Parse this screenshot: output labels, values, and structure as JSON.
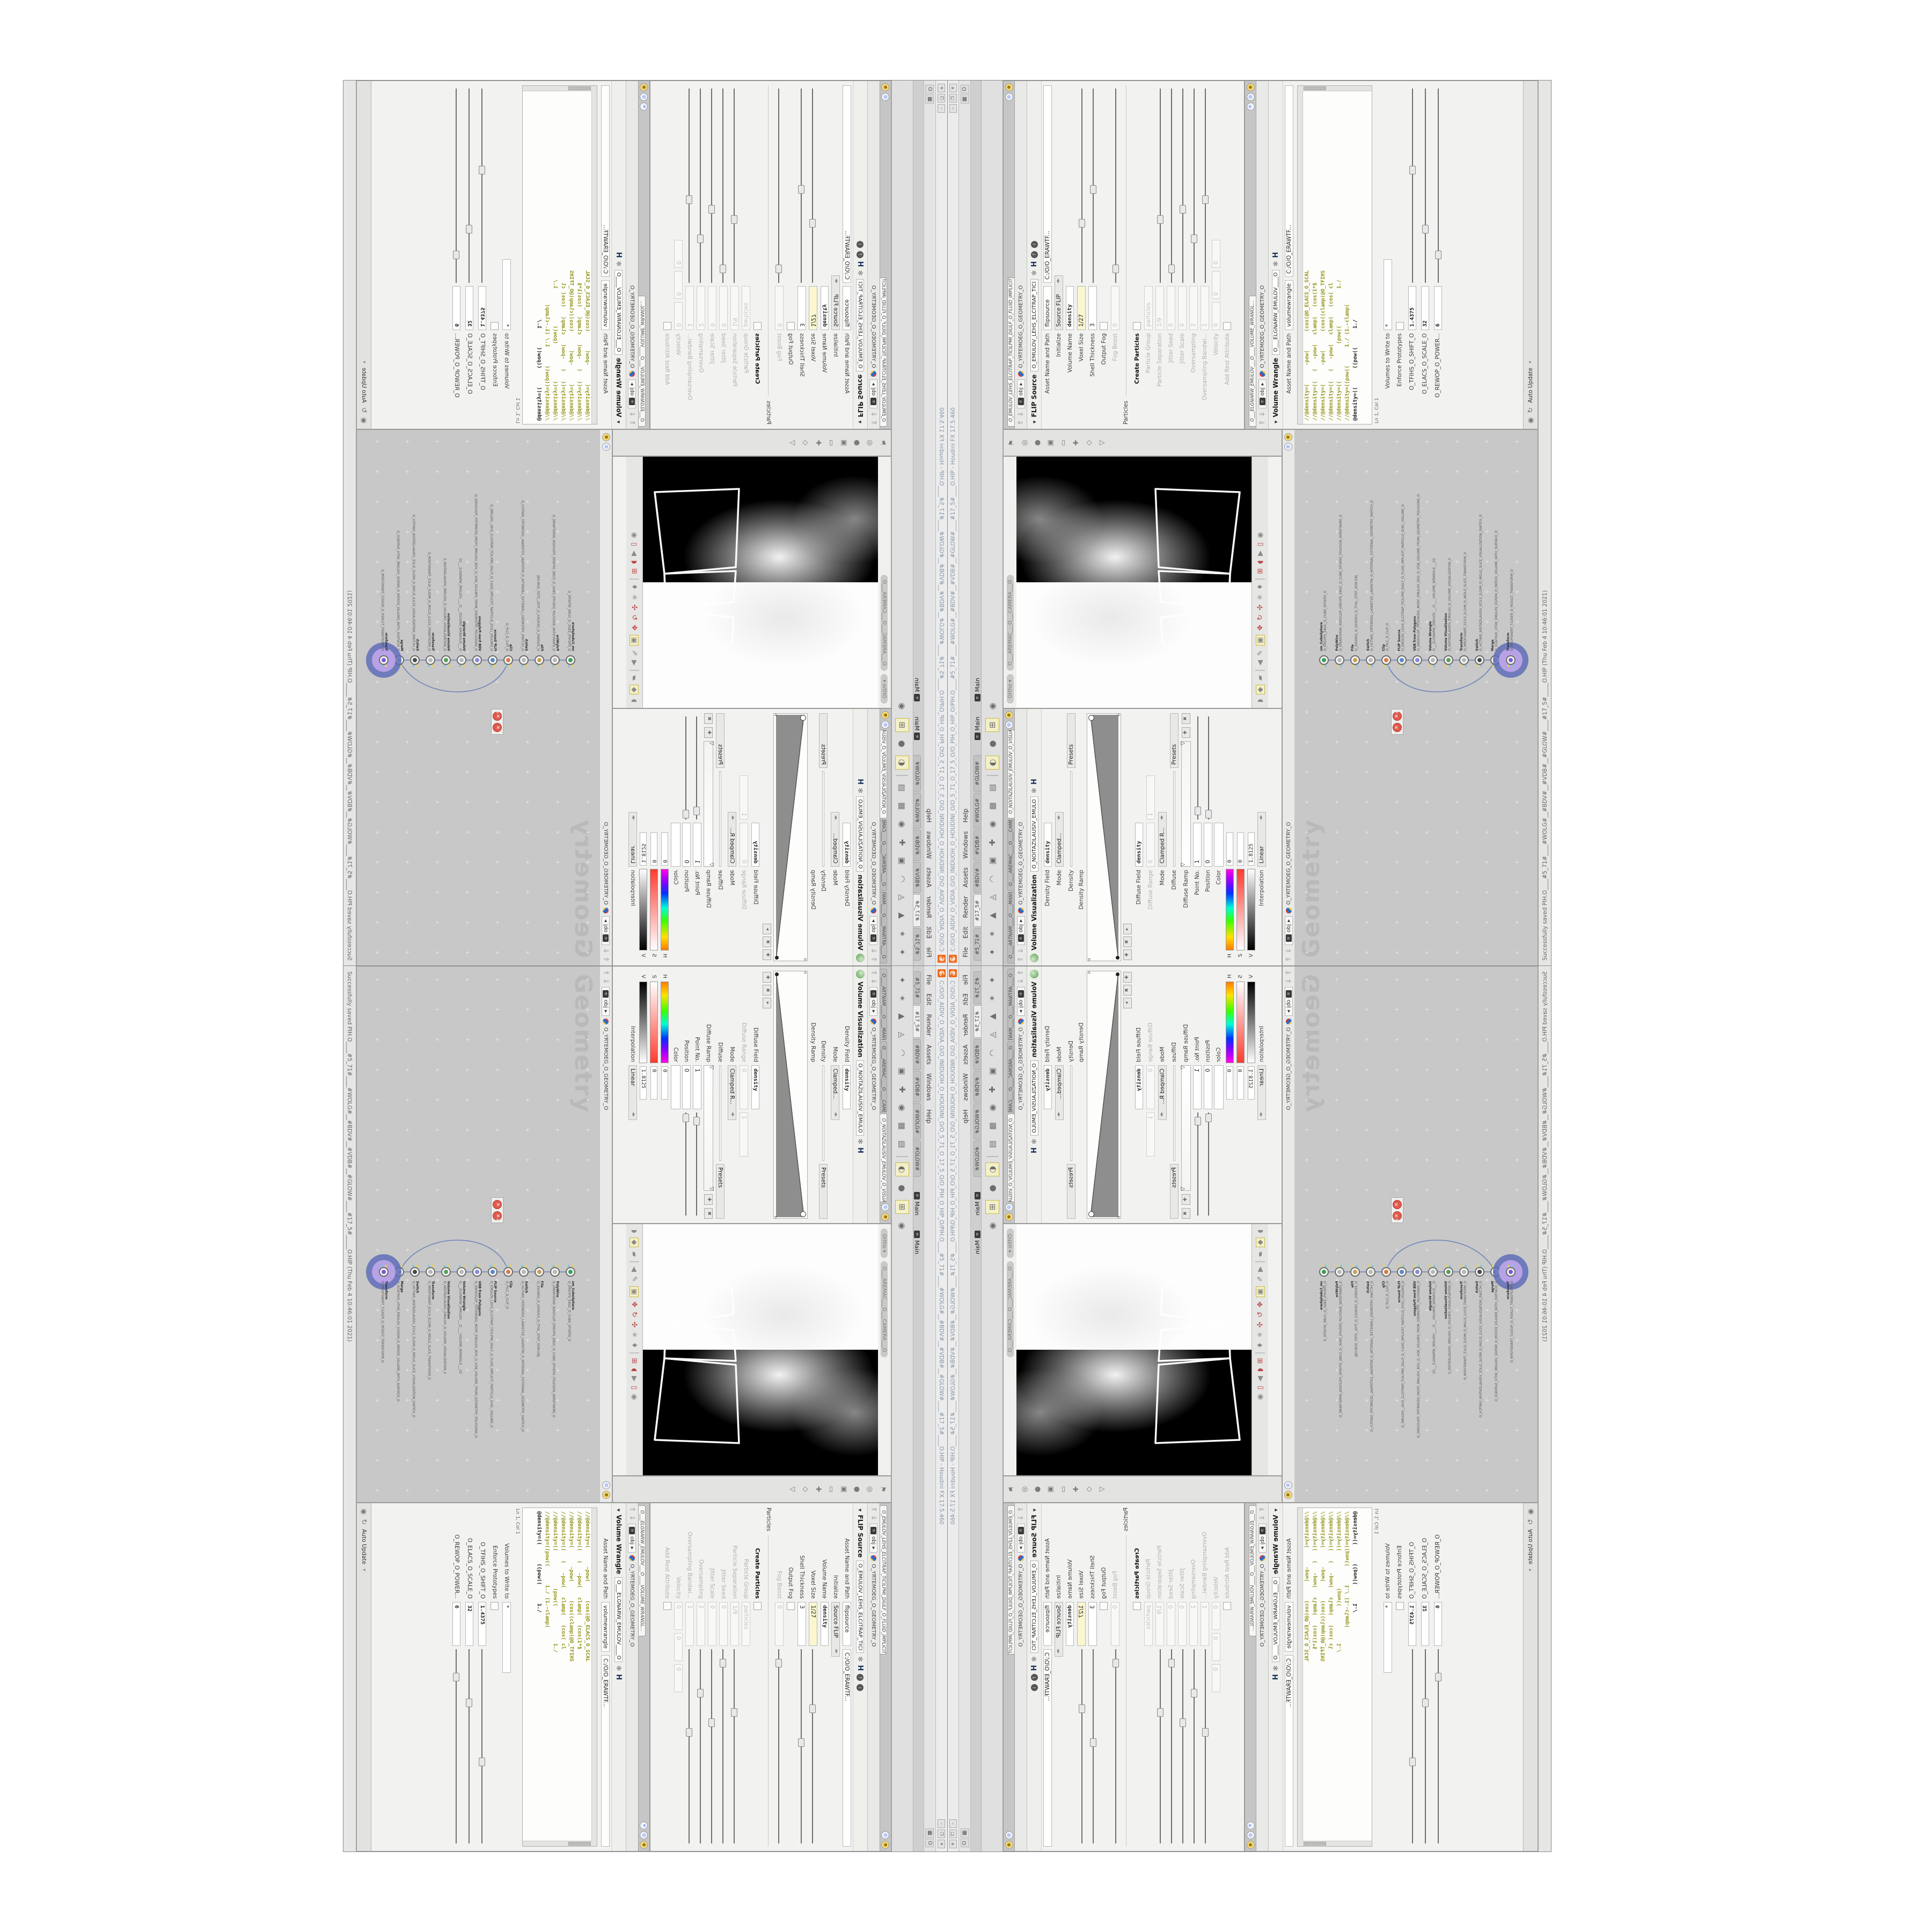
{
  "window": {
    "title": "C:/O/O_AIDIV_O_VIDIA_O/O_INIDUOH_O_HOUDINI_O/O_5_71_O_17_5_O/O_PIH_O_HIP_O/PIH.O____#5_71#____#WOLG#__#BDV#__#VDB#__#GLOW#____#17_5#____O.HIP - Houdini FX 17.5.460",
    "buttons": [
      "–",
      "❐",
      "✕"
    ]
  },
  "menubar": {
    "items": [
      "File",
      "Edit",
      "Render",
      "Assets",
      "Windows",
      "Help"
    ],
    "right_chip": "O"
  },
  "shelf": {
    "tabs": [
      "#5_71#",
      "#17_5#",
      "#BDV#",
      "#VDB#",
      "#WOLG#",
      "#GLOW#"
    ],
    "main_labels": [
      "Main",
      "Main"
    ],
    "tools": [
      {
        "name": "comet-icon",
        "glyph": "✦"
      },
      {
        "name": "character-icon",
        "glyph": "✶"
      },
      {
        "name": "cone-icon",
        "glyph": "▲"
      },
      {
        "name": "platonic-icon",
        "glyph": "◬"
      },
      {
        "name": "curve-icon",
        "glyph": "◠"
      },
      {
        "name": "points-box-icon",
        "glyph": "▣"
      },
      {
        "name": "propeller-icon",
        "glyph": "✚"
      },
      {
        "name": "wire-sphere-icon",
        "glyph": "◉"
      },
      {
        "name": "font-icon",
        "glyph": "▦"
      },
      {
        "name": "image-icon",
        "glyph": "▤"
      },
      {
        "name": "separator",
        "glyph": ""
      },
      {
        "name": "composite-view-icon",
        "glyph": "◐",
        "hl": 1
      },
      {
        "name": "visibility-icon",
        "glyph": "●"
      },
      {
        "name": "grid-plus-icon",
        "glyph": "⊞",
        "hl": 1
      },
      {
        "name": "eye-icon",
        "glyph": "◉"
      }
    ]
  },
  "viewport": {
    "ortho_pill": "Ortho ▾",
    "camera_pill": "O___AREMAC___O___CAMERA___O",
    "left_toolbar": [
      {
        "name": "pin-icon",
        "glyph": "⚑"
      },
      {
        "name": "bullseye-icon",
        "glyph": "◎"
      },
      {
        "name": "sphere-icon",
        "glyph": "●"
      },
      {
        "name": "box-icon",
        "glyph": "▣"
      },
      {
        "name": "marquee-icon",
        "glyph": "▭"
      },
      {
        "name": "handles-icon",
        "glyph": "✚"
      },
      {
        "name": "select-icon",
        "glyph": "◇"
      },
      {
        "name": "view-icon",
        "glyph": "▽"
      }
    ],
    "bottom_toolbar": [
      {
        "name": "shade-sphere-icon",
        "glyph": "◗"
      },
      {
        "name": "snap-diamond-icon",
        "glyph": "◆",
        "hl": 1
      },
      {
        "name": "page-icon",
        "glyph": "▰"
      },
      {
        "name": "separator",
        "glyph": "",
        "sep": 1
      },
      {
        "name": "back-icon",
        "glyph": "◀"
      },
      {
        "name": "draw-icon",
        "glyph": "✎"
      },
      {
        "name": "image-plane-icon",
        "glyph": "▣",
        "hl": 1
      },
      {
        "name": "gadget-icon",
        "glyph": "✥",
        "red": 1
      },
      {
        "name": "rotate-icon",
        "glyph": "↻",
        "red": 1
      },
      {
        "name": "transform-icon",
        "glyph": "✣",
        "red": 1
      },
      {
        "name": "wire-icon",
        "glyph": "✳"
      },
      {
        "name": "axis-icon",
        "glyph": "♦"
      },
      {
        "name": "separator2",
        "glyph": "",
        "sep": 1
      },
      {
        "name": "magnet-grid-icon",
        "glyph": "⊞",
        "red": 1
      },
      {
        "name": "magnet-icon",
        "glyph": "◖",
        "red": 1
      },
      {
        "name": "play-icon",
        "glyph": "▶"
      },
      {
        "name": "doc-icon",
        "glyph": "▯",
        "red": 1
      },
      {
        "name": "swirl-icon",
        "glyph": "◉"
      }
    ]
  },
  "volviz": {
    "tabs": [
      "O____ARTNAM____O____MANTRA____...",
      "O____AREMAC____O____CAMERA____...",
      "O_NOITAZILAUSIV_EMULOV_O_VISUALIZATION_..."
    ],
    "breadcrumb": {
      "path": "obj",
      "net": "O_YRTEMOEG_O_GEOMETRY_O"
    },
    "header": "Volume Visualization",
    "node_field": "O_NOITAZILAUSIV_EMULO",
    "density_field_label": "Density Field",
    "density_field_value": "density",
    "mode_label": "Mode",
    "mode_value": "Clamped...",
    "density_label": "Density",
    "presets_label": "Presets",
    "density_ramp_label": "Density Ramp",
    "diffuse_field_label": "Diffuse Field",
    "diffuse_field_value": "density",
    "diffuse_range_label": "Diffuse Range",
    "diffuse_range_min": "0",
    "diffuse_range_max": "1",
    "mode2_label": "Mode",
    "mode2_value": "Clamped R...",
    "diffuse_label": "Diffuse",
    "diffuse_ramp_label": "Diffuse Ramp",
    "point_no_label": "Point No.",
    "point_no_value": "1",
    "position_label": "Position",
    "position_value": "0",
    "color_label": "Color",
    "h_label": "H",
    "h_value": "0",
    "s_label": "S",
    "s_value": "0",
    "v_label": "V",
    "v_value": "1.8125",
    "interpolation_label": "Interpolation",
    "interpolation_value": "Linear"
  },
  "flip": {
    "tab": "O_EMULOV_LEHS_ELCITRAP_TICILPMI_DIULF_O_FLUID_IMPLICIT_PARTI...",
    "breadcrumb": {
      "path": "obj",
      "net": "O_YRTEMOEG_O_GEOMETRY_O"
    },
    "header": "FLIP Source",
    "node_field": "O_EMULOV_LEHS_ELCITRAP_TICI",
    "rows": [
      {
        "label": "Asset Name and Path",
        "type": "twofield",
        "v1": "flipsource",
        "v2": "C:/O/O_ERAWTF..."
      },
      {
        "label": "Initialize",
        "type": "menu",
        "value": "Source FLIP"
      },
      {
        "label": "Volume Name",
        "type": "boldfield",
        "value": "density"
      },
      {
        "label": "Voxel Size",
        "type": "yellow",
        "value": "1/27",
        "slider": 0.28
      },
      {
        "label": "Shell Thickness",
        "type": "field",
        "value": "3",
        "slider": 0.45
      },
      {
        "label": "Output Fog",
        "type": "check"
      },
      {
        "label": "Fog Boost",
        "type": "field",
        "value": "0",
        "dim": 1,
        "slider": 0.05
      },
      {
        "label": "Particles",
        "type": "group"
      },
      {
        "label": "Create Particles",
        "type": "check",
        "boldlabel": 1
      },
      {
        "label": "Particle Group",
        "type": "field",
        "value": "particles",
        "dim": 1
      },
      {
        "label": "Particle Separation",
        "type": "field",
        "value": "1/9",
        "dim": 1,
        "slider": 0.3
      },
      {
        "label": "Jitter Seed",
        "type": "field",
        "value": "0",
        "dim": 1,
        "slider": 0.05
      },
      {
        "label": "Jitter Scale",
        "type": "field",
        "value": "0",
        "dim": 1,
        "slider": 0.35
      },
      {
        "label": "Oversampling",
        "type": "field",
        "value": "2",
        "dim": 1,
        "slider": 0.2
      },
      {
        "label": "Oversampling Bandwi...",
        "type": "field",
        "value": "1",
        "dim": 1,
        "slider": 0.4
      },
      {
        "label": "Velocity",
        "type": "vec",
        "values": [
          "0",
          "0",
          "0"
        ],
        "dim": 1
      },
      {
        "label": "Add Rest Attribute",
        "type": "check",
        "dim": 1
      }
    ]
  },
  "wrangle": {
    "tab": "O___ELGNARW_EMULOV___O____VOLUME_WRANGL...",
    "breadcrumb": {
      "path": "obj",
      "net": "O_YRTEMOEG_O_GEOMETRY_O"
    },
    "header": "Volume Wrangle",
    "node_field": "O___ELGNARW_EMULOV____O",
    "asset_label": "Asset Name and Path",
    "asset_value": "volumewrangle",
    "path_value": "C:/O/O_ERAWTF...",
    "code": [
      "//@density=(      -pow(      (cos(@O_ELACS_O_SCAL",
      "//@density=((   (   -pow(   clamp(   (cos(1*$",
      "//@density=(      -pow(      (cos((clamp(@O_TFIHS",
      "//@density=((   (   -pow(   clamp(   (cos( cl",
      "//@density=((            (pow((            1./",
      "//@density=((pow((      1./ (1.-clamp(",
      "@density=((      ((pow((      1./"
    ],
    "cursor_label": "Ln 1, Col 1",
    "volumes_label": "Volumes to Write to",
    "volumes_value": "*",
    "enforce_label": "Enforce Prototypes",
    "sliders": [
      {
        "label": "O_TFIHS_O_SHIFT_O",
        "value": "1.4375",
        "slider": 0.55
      },
      {
        "label": "O_ELACS_O_SCALE_O",
        "value": "32",
        "slider": 0.25
      },
      {
        "label": "O_REWOP_O_POWER...",
        "value": "6",
        "slider": 0.12
      }
    ],
    "auto_update_label": "Auto Update"
  },
  "network": {
    "breadcrumb": {
      "path": "obj",
      "net": "O_YRTEMOEG_O_GEOMETRY_O"
    },
    "watermark": "Geometry",
    "nodes": [
      {
        "type": "sm_CubeSphere",
        "name": "O_EREHPS_EBUC_O_CUBE_SPHERE_O",
        "color": "#3aa05a"
      },
      {
        "type": "PolyWire",
        "name": "O_EMARFERIW_NOGYLOP_EREHPS_EBUC_O_CUBE_SPHERE_POLYGON_WIREFRAME_O",
        "color": "#b8b8b8"
      },
      {
        "type": "File",
        "name": "O_3SUNEG_O_GENUS3_O_TFOL_STEP_3DM.OBJ",
        "color": "#c8a05a"
      },
      {
        "type": "Switch",
        "name": "O_HCTIWS_YRTEMOEG_LANRETXE_LANRETNI_O_INTERNAL_EXTERNAL_GEOMETRY_SWITCH_O",
        "color": "#b8b8b8"
      },
      {
        "type": "Clip",
        "name": "O_PILC_O_CLIP_O",
        "color": "#d87a4a"
      },
      {
        "type": "FLIP Source",
        "name": "O_EMULOV_LEHS_ELCITRAP_TICILPMI_DIULF_O_FLUID_IMPLICIT_PARTICLE_SHEL_VOLUME_O",
        "color": "#5a8ac8"
      },
      {
        "type": "VDB from Polygons",
        "name": "O_SNOGYLOP_YRTEMOEG_MORF_EMULOV_BDV_O_VDB_VOLUME_FROM_GEOMETRY_POLYGONS_O",
        "color": "#8a8ad8"
      },
      {
        "type": "Volume Wrangle",
        "name": "O___ELGNARW_EMULOV___O____VOLUME_WRANGLE___02",
        "color": "#b8b8b8"
      },
      {
        "type": "Volume Visualization",
        "name": "O_NOITAZILAUSIV_EMULOV_O_VOLUME_VISUALIZATION_0",
        "color": "#5aa05a"
      },
      {
        "type": "Transform",
        "name": "O_MROFSNART_ECILS_ELDIM_O_MIDLE_SLICE_TRANSFORM_O",
        "color": "#b8b8b8"
      },
      {
        "type": "Switch",
        "name": "O_HCTIWS_NOITAZILAUSIV_ECILS_ELDIM_O_MIDLE_SLICE_VISUALIZATION_SWITCH_O",
        "color": "#4a4a4a"
      },
      {
        "type": "Merge",
        "name": "O_ECAFRUS_HTIW_EMULOV_EGREM_O_MERGE_VOLUME_WITH_SURFACE_O",
        "color": "#b8b8b8"
      },
      {
        "type": "Transform",
        "name": "O_MROFSNART_TLUSER_O_RESULT_TRANSFORM_O",
        "color": "#7a5ad8",
        "selected": 1
      }
    ]
  },
  "statusbar": {
    "text": "Successfully saved PIH.O____#5_71#____#WOLG#__#BDV#__#VDB#__#GLOW#____#17_5#_____O.HIP (Thu Feb  4 10:46:01 2021)"
  },
  "colors": {
    "houdini_orange": "#f06b1f",
    "halo_outer": "#5a68b8",
    "halo_inner": "#b7a2e6",
    "network_bg": "#c8c8c8",
    "code_olive": "#95951c",
    "code_teal": "#17868a",
    "yellow_field": "#faf6cf",
    "viewport_black": "#000000"
  }
}
